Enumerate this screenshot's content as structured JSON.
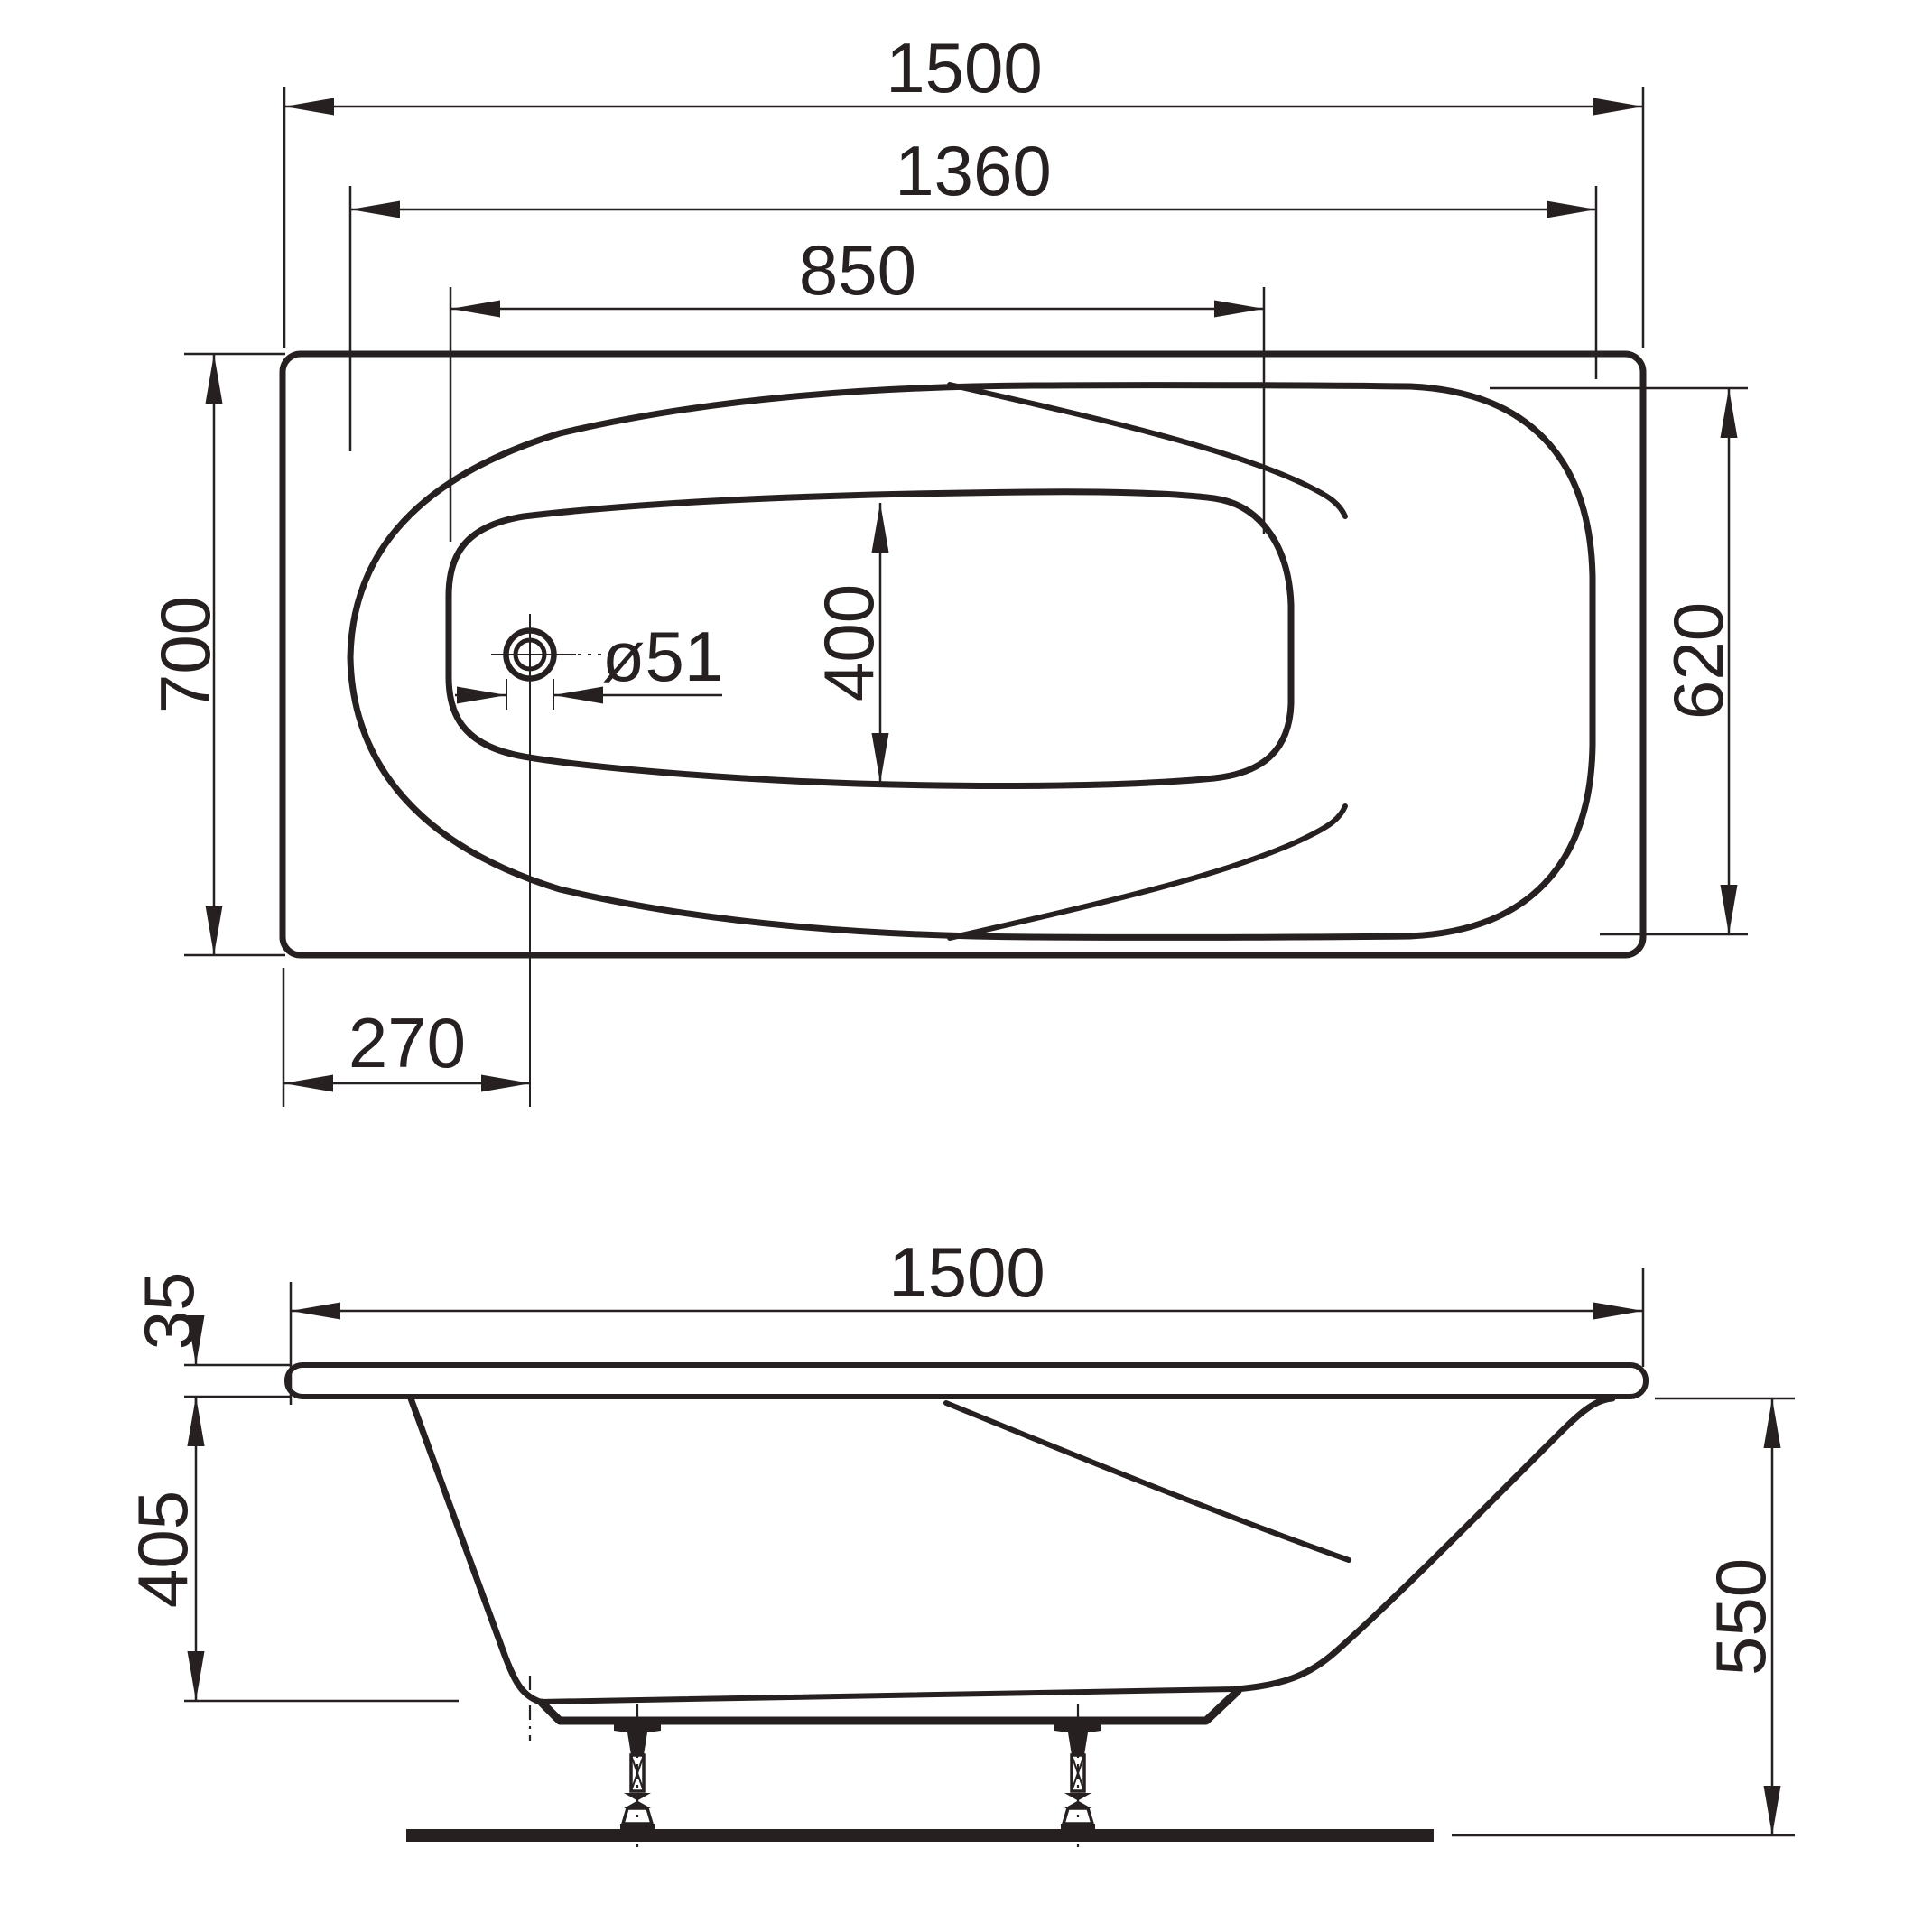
{
  "drawing": {
    "type": "bathtub installation technical drawing, top view and side view",
    "background_color": "#ffffff",
    "ink_color": "#262120",
    "views": {
      "top": {
        "name": "top view (plan)"
      },
      "side": {
        "name": "side view (elevation)"
      }
    },
    "dims": {
      "top": {
        "overall_length": "1500",
        "inner_rim_length": "1360",
        "floor_length": "850",
        "overall_width": "700",
        "inner_rim_width": "620",
        "floor_width": "400",
        "drain_diameter": "ø51",
        "drain_offset": "270"
      },
      "side": {
        "overall_length": "1500",
        "rim_thickness": "35",
        "shell_depth": "405",
        "total_height": "550"
      }
    }
  }
}
